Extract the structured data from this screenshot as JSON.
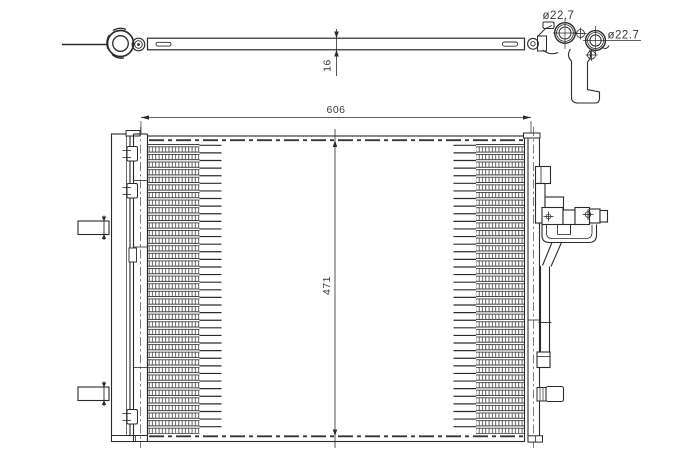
{
  "labels": {
    "width": "606",
    "height": "471",
    "depth": "16",
    "port_top": "ø22.7",
    "port_side": "ø22.7"
  },
  "core": {
    "tube_rows": 38,
    "row_pitch": 7.605,
    "first_tube_y": 145.3,
    "left_band_x1": 147.5,
    "left_band_x2": 199.5,
    "left_ext_x": 221.5,
    "right_band_x1": 476,
    "right_band_x2": 524.5,
    "right_ext_x": 453.5
  },
  "colors": {
    "line": "#2b2b2b",
    "thin": "#3f3f3f",
    "dim": "#3a3a3a",
    "background": "#ffffff"
  }
}
